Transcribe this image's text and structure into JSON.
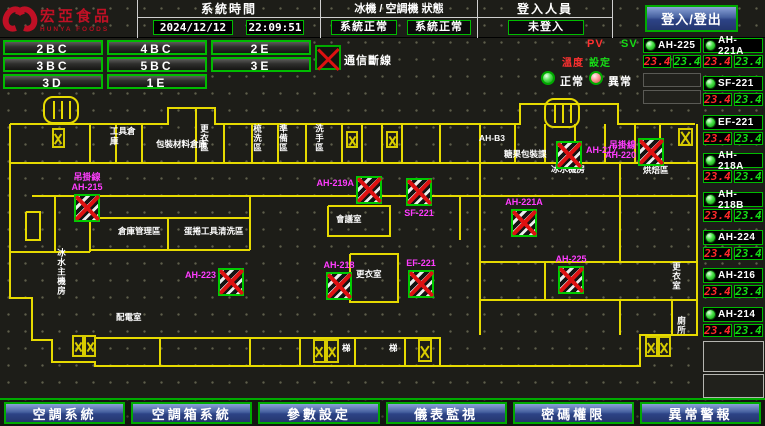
{
  "header": {
    "logo_title": "宏亞食品",
    "logo_subtitle": "HUNYA FOODS",
    "time_label": "系統時間",
    "date": "2024/12/12",
    "time": "22:09:51",
    "status_label": "冰機 / 空調機 狀態",
    "status_chiller": "系統正常",
    "status_ahu": "系統正常",
    "login_label": "登入人員",
    "login_value": "未登入",
    "login_button": "登入/登出"
  },
  "floor_buttons": [
    "2BC",
    "4BC",
    "2E",
    "3BC",
    "5BC",
    "3E",
    "3D",
    "1E"
  ],
  "legend": {
    "disconnect": "通信斷線",
    "normal": "正常",
    "abnormal": "異常",
    "pv": "PV",
    "sv": "SV",
    "temp": "溫度",
    "set": "設定"
  },
  "units": {
    "aux": {
      "name": "AH-225",
      "pv": "23.4",
      "sv": "23.4"
    },
    "list": [
      {
        "name": "AH-221A",
        "pv": "23.4",
        "sv": "23.4"
      },
      {
        "name": "SF-221",
        "pv": "23.4",
        "sv": "23.4"
      },
      {
        "name": "EF-221",
        "pv": "23.4",
        "sv": "23.4"
      },
      {
        "name": "AH-218A",
        "pv": "23.4",
        "sv": "23.4"
      },
      {
        "name": "AH-218B",
        "pv": "23.4",
        "sv": "23.4"
      },
      {
        "name": "AH-224",
        "pv": "23.4",
        "sv": "23.4"
      },
      {
        "name": "AH-216",
        "pv": "23.4",
        "sv": "23.4"
      },
      {
        "name": "AH-214",
        "pv": "23.4",
        "sv": "23.4"
      }
    ]
  },
  "floorplan": {
    "devices": [
      {
        "label": "吊掛線",
        "label2": "AH-215",
        "x": 74,
        "y": 194,
        "lp": "above"
      },
      {
        "label": "AH-223",
        "x": 218,
        "y": 268,
        "lp": "left"
      },
      {
        "label": "AH-219A",
        "x": 356,
        "y": 176,
        "lp": "left"
      },
      {
        "label": "SF-221",
        "x": 406,
        "y": 178,
        "lp": "below"
      },
      {
        "label": "AH-218",
        "x": 326,
        "y": 272,
        "lp": "above"
      },
      {
        "label": "EF-221",
        "x": 408,
        "y": 270,
        "lp": "above"
      },
      {
        "label": "AH-217",
        "x": 556,
        "y": 141,
        "lp": "right"
      },
      {
        "label": "吊掛線",
        "label2": "AH-220",
        "x": 638,
        "y": 138,
        "lp": "left"
      },
      {
        "label": "AH-221A",
        "x": 511,
        "y": 209,
        "lp": "above"
      },
      {
        "label": "AH-225",
        "x": 558,
        "y": 266,
        "lp": "above"
      }
    ],
    "rooms": [
      {
        "t": "工具倉庫",
        "x": 110,
        "y": 127,
        "w": 26
      },
      {
        "t": "包裝材料倉庫",
        "x": 156,
        "y": 140
      },
      {
        "t": "更衣區",
        "x": 199,
        "y": 124,
        "v": true
      },
      {
        "t": "梳洗區",
        "x": 252,
        "y": 124,
        "v": true
      },
      {
        "t": "準備區",
        "x": 278,
        "y": 124,
        "v": true
      },
      {
        "t": "洗手區",
        "x": 314,
        "y": 124,
        "v": true
      },
      {
        "t": "AH-B3",
        "x": 479,
        "y": 134
      },
      {
        "t": "糖果包裝課",
        "x": 504,
        "y": 150
      },
      {
        "t": "冰水機房",
        "x": 551,
        "y": 165
      },
      {
        "t": "烘焙區",
        "x": 643,
        "y": 166
      },
      {
        "t": "會議室",
        "x": 336,
        "y": 215
      },
      {
        "t": "更衣室",
        "x": 356,
        "y": 270
      },
      {
        "t": "倉庫管理區",
        "x": 118,
        "y": 227
      },
      {
        "t": "蛋捲工具清洗區",
        "x": 184,
        "y": 227
      },
      {
        "t": "配電室",
        "x": 116,
        "y": 313
      },
      {
        "t": "冰水主機房",
        "x": 56,
        "y": 248,
        "v": true
      },
      {
        "t": "更衣室",
        "x": 671,
        "y": 262,
        "v": true
      },
      {
        "t": "廁所",
        "x": 676,
        "y": 316,
        "v": true
      },
      {
        "t": "梯",
        "x": 342,
        "y": 344
      },
      {
        "t": "梯",
        "x": 389,
        "y": 344
      }
    ],
    "stairs": [
      {
        "x": 52,
        "y": 128,
        "w": 13,
        "h": 20
      },
      {
        "x": 346,
        "y": 131,
        "w": 12,
        "h": 17
      },
      {
        "x": 386,
        "y": 131,
        "w": 12,
        "h": 17
      },
      {
        "x": 678,
        "y": 128,
        "w": 15,
        "h": 18
      },
      {
        "x": 72,
        "y": 335,
        "w": 12,
        "h": 22
      },
      {
        "x": 84,
        "y": 335,
        "w": 12,
        "h": 22
      },
      {
        "x": 313,
        "y": 339,
        "w": 13,
        "h": 24
      },
      {
        "x": 326,
        "y": 339,
        "w": 13,
        "h": 24
      },
      {
        "x": 418,
        "y": 339,
        "w": 14,
        "h": 23
      },
      {
        "x": 645,
        "y": 336,
        "w": 13,
        "h": 21
      },
      {
        "x": 658,
        "y": 336,
        "w": 13,
        "h": 21
      }
    ]
  },
  "nav": [
    "空調系統",
    "空調箱系統",
    "參數設定",
    "儀表監視",
    "密碼權限",
    "異常警報"
  ],
  "colors": {
    "accent_green": "#00bb00",
    "alarm_red": "#dd1111",
    "label_magenta": "#ff3cff",
    "wall_yellow": "#e6da00",
    "button_blue": "#46609f",
    "logo_red": "#c01025"
  }
}
